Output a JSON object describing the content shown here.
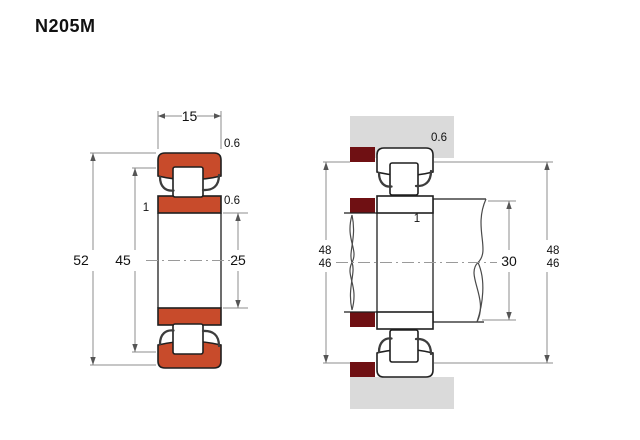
{
  "title": "N205M",
  "colors": {
    "ring_fill": "#c84b2b",
    "abutment_fill": "#6f1013",
    "housing_fill": "#dadada"
  },
  "left_view": {
    "label": "bearing cross-section",
    "dims": {
      "width": "15",
      "outer_chamfer": "0.6",
      "inner_chamfer": "0.6",
      "rib_width": "1",
      "outer_diameter": "52",
      "flange_diameter": "45",
      "bore_diameter": "25"
    }
  },
  "right_view": {
    "label": "mounted arrangement",
    "dims": {
      "outer_chamfer": "0.6",
      "rib_width": "1",
      "shaft_shoulder_diameter": "30",
      "left_abutment_upper": "48",
      "left_abutment_lower": "46",
      "right_abutment_upper": "48",
      "right_abutment_lower": "46"
    }
  }
}
